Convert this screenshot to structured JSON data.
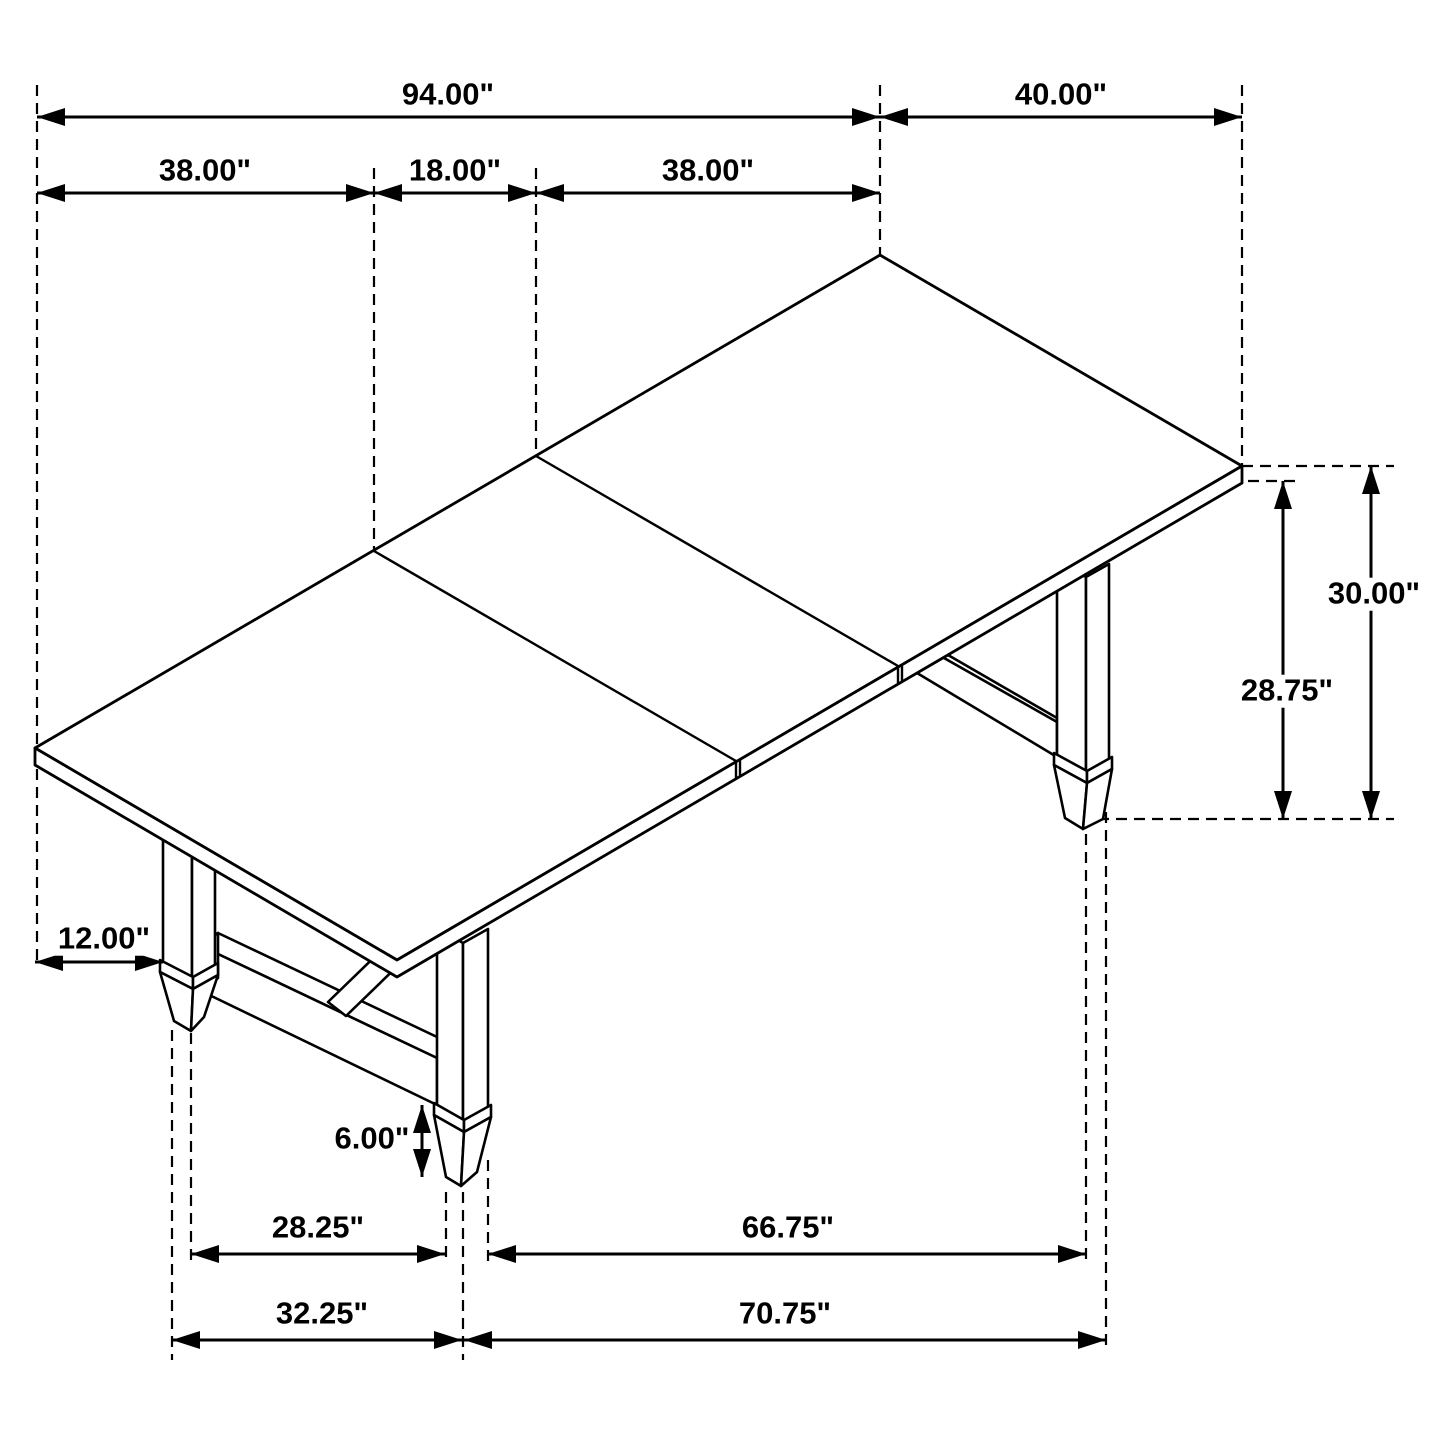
{
  "drawing": {
    "type": "isometric-dimension-drawing",
    "subject": "rectangular trestle dining table with three top leaves",
    "background_color": "#ffffff",
    "line_color": "#000000",
    "units": "inches"
  },
  "dims": {
    "table_length": "94.00\"",
    "table_width": "40.00\"",
    "leaf_left": "38.00\"",
    "leaf_center": "18.00\"",
    "leaf_right": "38.00\"",
    "height_total": "30.00\"",
    "height_underside": "28.75\"",
    "leg_inset": "12.00\"",
    "stretcher_clearance": "6.00\"",
    "feet_inner_left_span": "28.25\"",
    "feet_inner_right_span": "66.75\"",
    "feet_outer_left_span": "32.25\"",
    "feet_outer_right_span": "70.75\""
  }
}
